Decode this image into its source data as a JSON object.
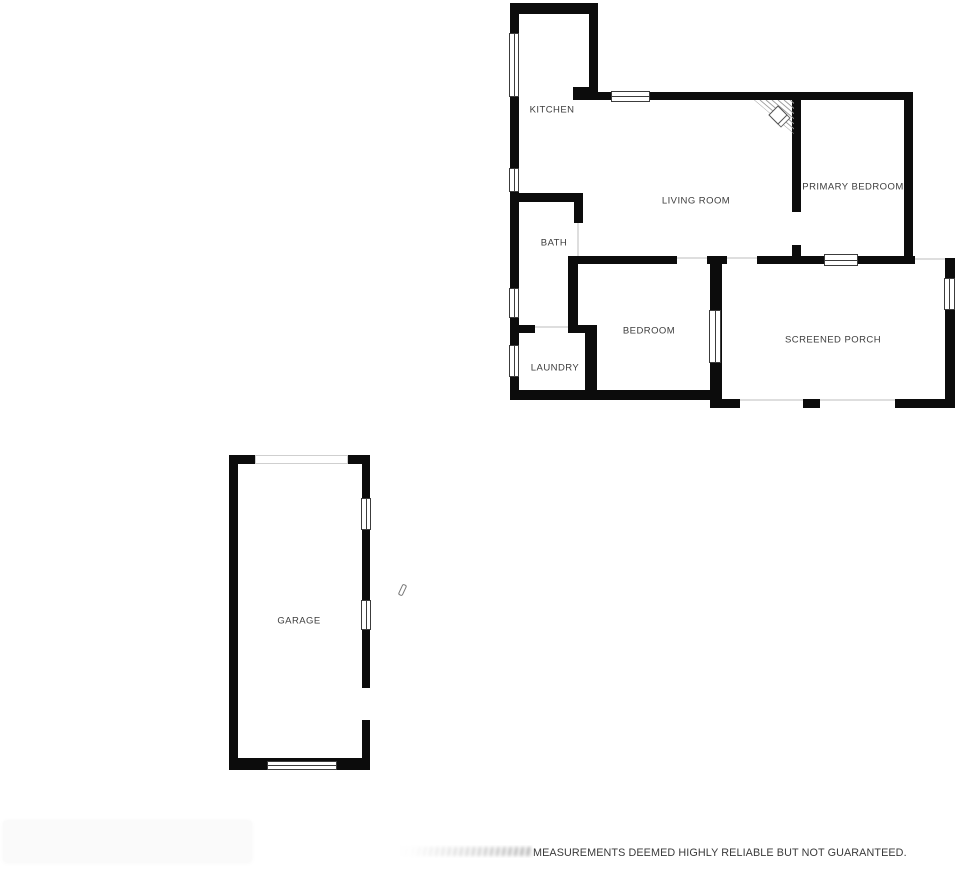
{
  "rooms": {
    "kitchen": {
      "label": "KITCHEN"
    },
    "living_room": {
      "label": "LIVING ROOM"
    },
    "primary_bedroom": {
      "label": "PRIMARY BEDROOM"
    },
    "bath": {
      "label": "BATH"
    },
    "bedroom": {
      "label": "BEDROOM"
    },
    "laundry": {
      "label": "LAUNDRY"
    },
    "screened_porch": {
      "label": "SCREENED PORCH"
    },
    "garage": {
      "label": "GARAGE"
    }
  },
  "footer": {
    "disclaimer": "MEASUREMENTS DEEMED HIGHLY RELIABLE BUT NOT GUARANTEED."
  },
  "colors": {
    "wall": "#0c0c0c",
    "label_text": "#3d3d3d",
    "window_frame": "#3c3c3c",
    "opening_line": "#dedede"
  }
}
